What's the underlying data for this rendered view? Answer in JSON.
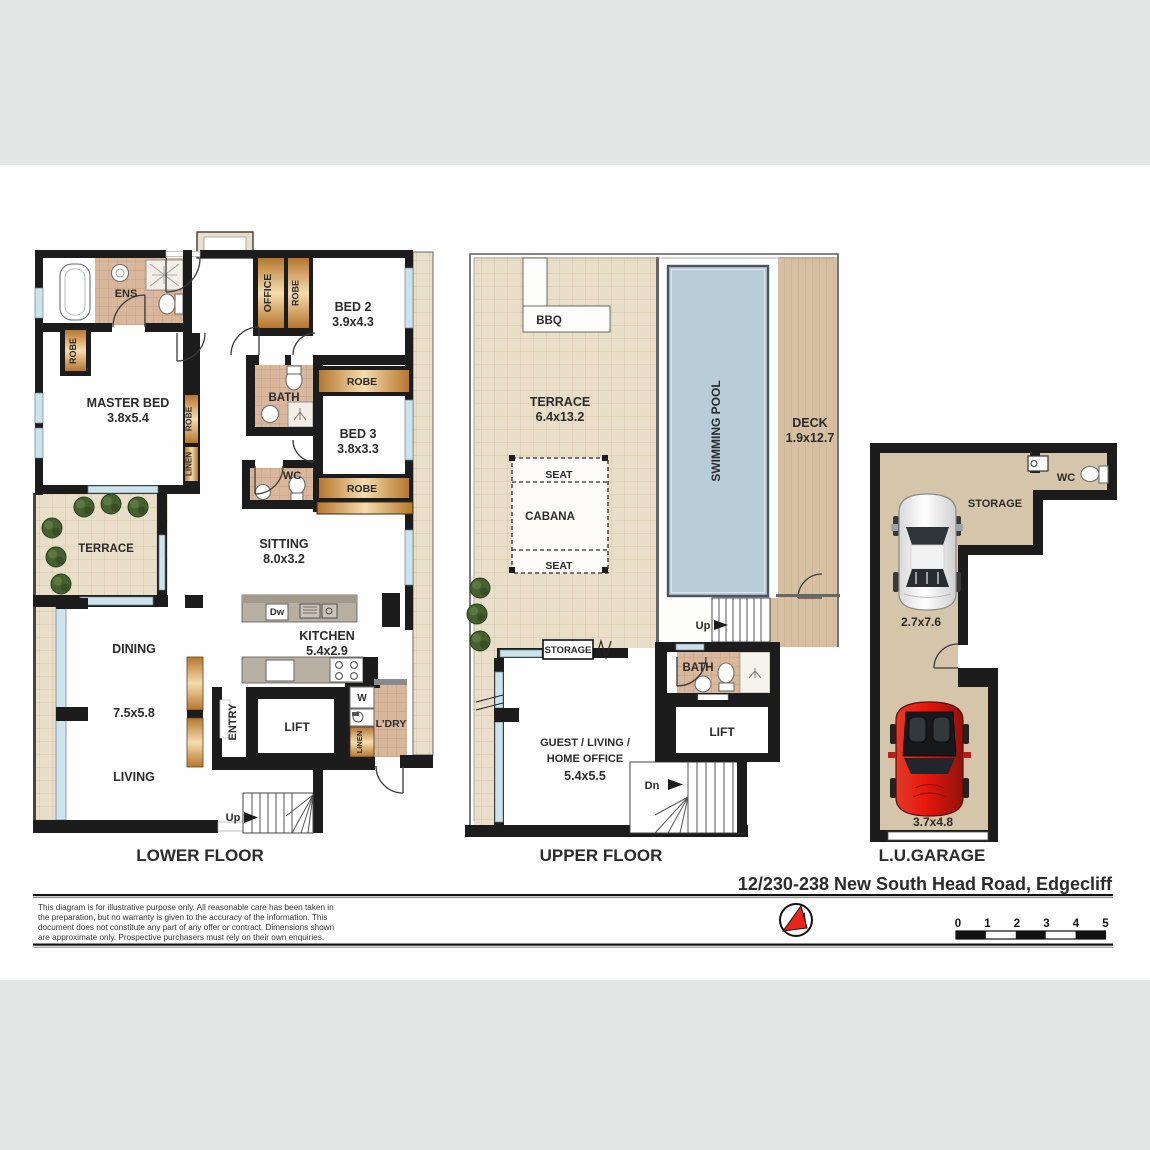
{
  "header": {
    "address": "12/230-238 New South Head Road, Edgecliff"
  },
  "lower": {
    "label": "LOWER FLOOR",
    "ens": "ENS",
    "master_name": "MASTER BED",
    "master_dims": "3.8x5.4",
    "robe_master": "ROBE",
    "robe_hall": "ROBE",
    "linen_hall": "LINEN",
    "office": "OFFICE",
    "robe_office": "ROBE",
    "bed2_name": "BED 2",
    "bed2_dims": "3.9x4.3",
    "bath": "BATH",
    "robe_bed2": "ROBE",
    "bed3_name": "BED 3",
    "bed3_dims": "3.8x3.3",
    "wc": "WC",
    "robe_bed3": "ROBE",
    "sitting_name": "SITTING",
    "sitting_dims": "8.0x3.2",
    "terrace": "TERRACE",
    "dining": "DINING",
    "living_dims": "7.5x5.8",
    "living": "LIVING",
    "kitchen_name": "KITCHEN",
    "kitchen_dims": "5.4x2.9",
    "dishwasher": "Dw",
    "entry": "ENTRY",
    "lift": "LIFT",
    "washer": "W",
    "linen_laundry": "LINEN",
    "laundry": "L'DRY",
    "up": "Up"
  },
  "upper": {
    "label": "UPPER FLOOR",
    "bbq": "BBQ",
    "terrace_name": "TERRACE",
    "terrace_dims": "6.4x13.2",
    "seat_top": "SEAT",
    "cabana": "CABANA",
    "seat_bottom": "SEAT",
    "pool": "SWIMMING POOL",
    "deck_name": "DECK",
    "deck_dims": "1.9x12.7",
    "up": "Up",
    "storage": "STORAGE",
    "bath": "BATH",
    "lift": "LIFT",
    "guest_line1": "GUEST / LIVING /",
    "guest_line2": "HOME OFFICE",
    "guest_dims": "5.4x5.5",
    "dn": "Dn"
  },
  "garage": {
    "label": "L.U.GARAGE",
    "wc": "WC",
    "storage": "STORAGE",
    "space1_dims": "2.7x7.6",
    "space2_dims": "3.7x4.8"
  },
  "footer": {
    "disclaimer_line1": "This diagram is for illustrative purpose only. All reasonable care has been taken in",
    "disclaimer_line2": "the preparation, but no warranty is given to the accuracy of the information. This",
    "disclaimer_line3": "document does not constitute any part of any offer or contract. Dimensions shown",
    "disclaimer_line4": "are approximate only. Prospective purchasers must rely on their own enquiries.",
    "compass_letter": "N",
    "scale_ticks": [
      "0",
      "1",
      "2",
      "3",
      "4",
      "5"
    ]
  }
}
